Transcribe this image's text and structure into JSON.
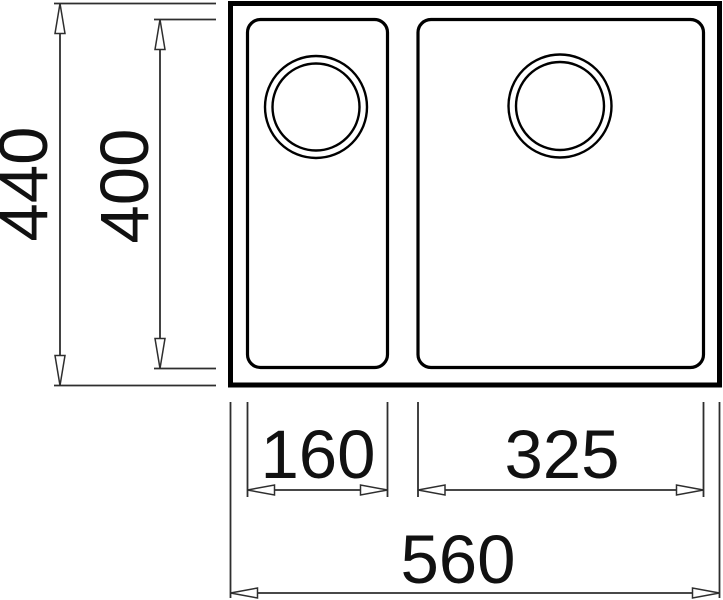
{
  "drawing": {
    "name": "sink-top-view-dimension-drawing",
    "dimensions": {
      "overall_depth": "440",
      "bowl_depth": "400",
      "left_bowl_width": "160",
      "right_bowl_width": "325",
      "overall_width": "560"
    },
    "colors": {
      "background": "#ffffff",
      "outline": "#000000",
      "dimension_lines": "#2e2e2e",
      "label_text": "#111111"
    }
  }
}
